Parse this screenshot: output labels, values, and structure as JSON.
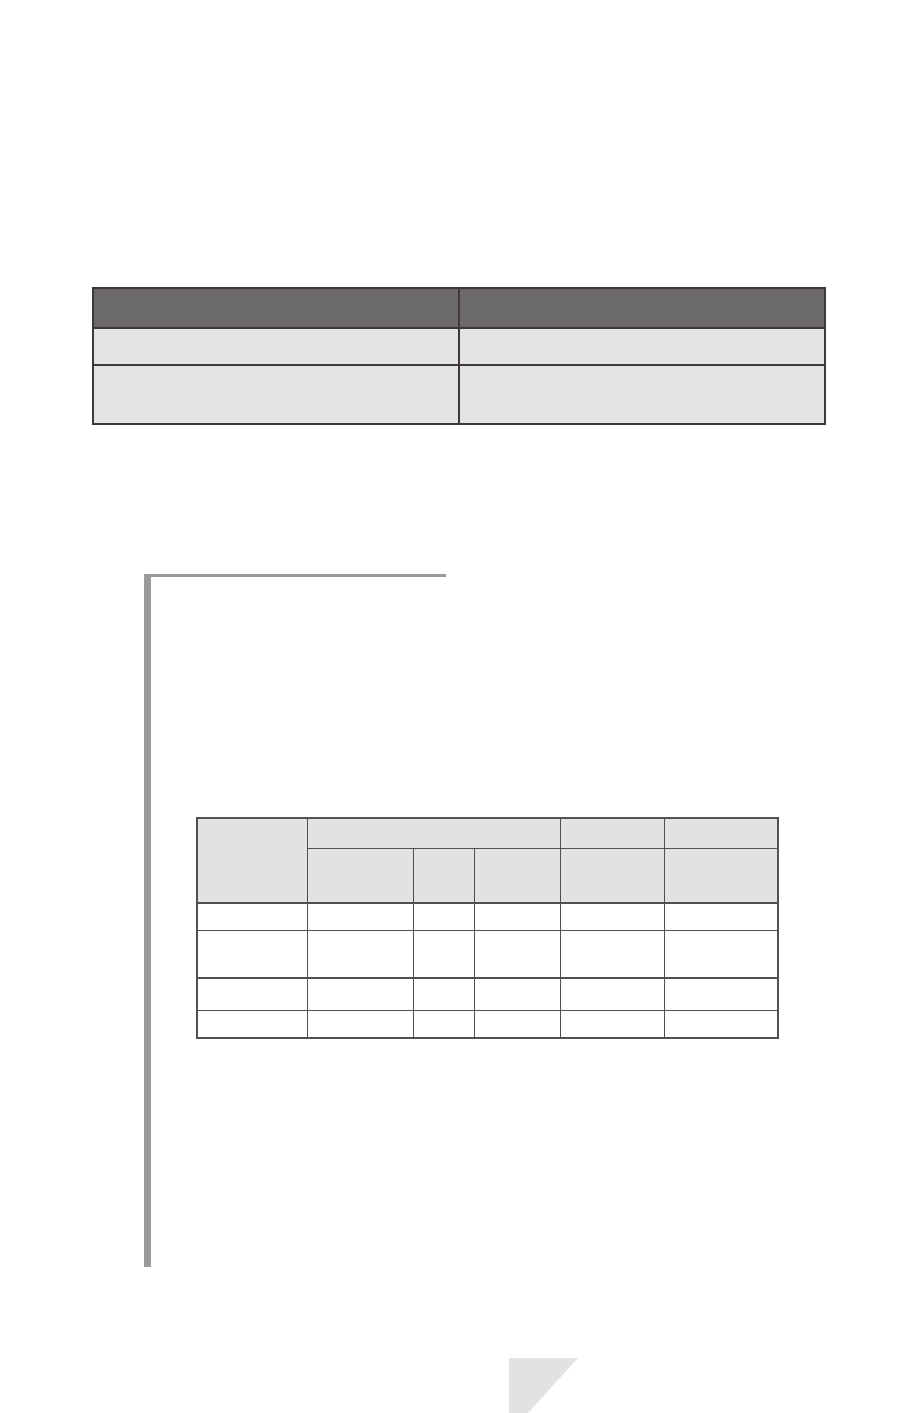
{
  "colors": {
    "page_bg": "#ffffff",
    "table1_header_fill": "#6c696a",
    "table1_row_fill": "#e4e3e3",
    "table1_border": "#3e3938",
    "table2_header_fill": "#e3e2e2",
    "table2_body_fill": "#ffffff",
    "table2_border": "#55504e",
    "bracket_color": "#9a9a99",
    "triangle_color": "#e2e2e2"
  },
  "table1": {
    "header_cells": [
      "",
      ""
    ],
    "rows": [
      [
        "",
        ""
      ],
      [
        "",
        ""
      ]
    ]
  },
  "table2": {
    "corner_cell": "",
    "group_header": "",
    "header_row1_right": [
      "",
      ""
    ],
    "header_row2": [
      "",
      "",
      "",
      "",
      ""
    ],
    "body_rows": [
      [
        "",
        "",
        "",
        "",
        "",
        ""
      ],
      [
        "",
        "",
        "",
        "",
        "",
        ""
      ],
      [
        "",
        "",
        "",
        "",
        "",
        ""
      ],
      [
        "",
        "",
        "",
        "",
        "",
        ""
      ]
    ]
  }
}
